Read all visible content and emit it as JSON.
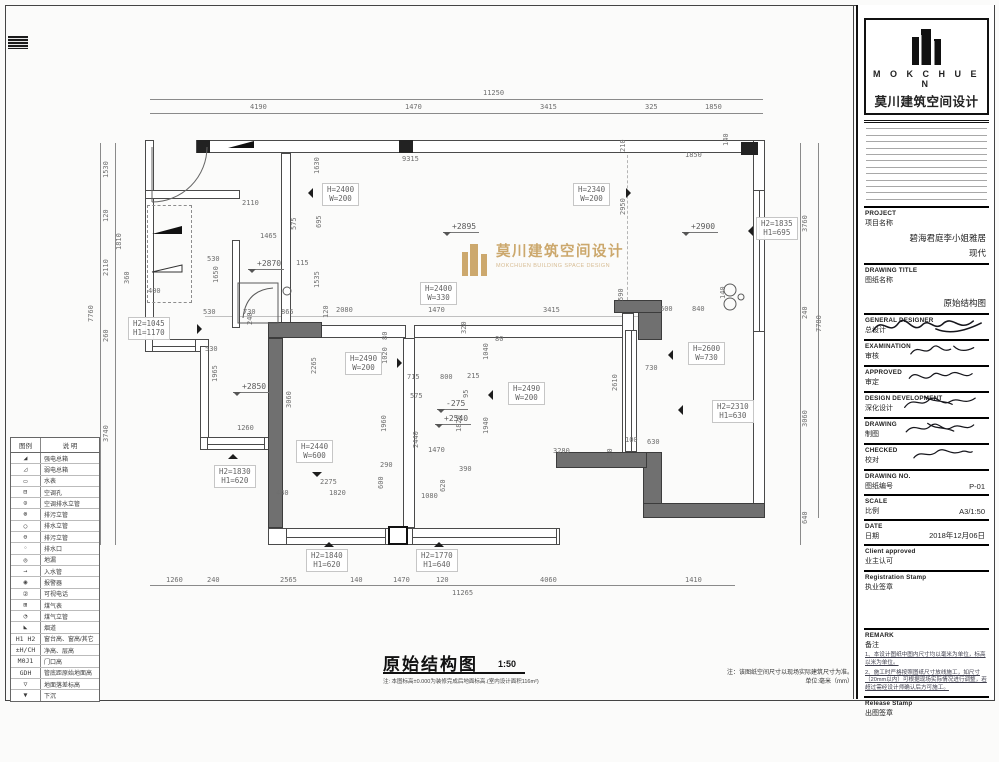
{
  "watermark": {
    "cn": "莫川建筑空间设计",
    "en": "MOKCHUEN BUILDING SPACE DESIGN",
    "gold": "#c7a05e"
  },
  "footer": {
    "title": "原始结构图",
    "scale": "1:50",
    "note": "注: 本图标高±0.000为装修完成后地面标高.(室内设计面积116m²)",
    "right_note1": "注：该图纸空间尺寸以现场实际建筑尺寸为准。",
    "right_note2": "单位:毫米（mm）"
  },
  "legend": {
    "col1": "图例",
    "col2": "说 明",
    "rows": [
      {
        "sym": "◢",
        "label": "强电总箱"
      },
      {
        "sym": "◿",
        "label": "弱电总箱"
      },
      {
        "sym": "▭",
        "label": "水表"
      },
      {
        "sym": "⊟",
        "label": "空调孔"
      },
      {
        "sym": "⊙",
        "label": "空调排水立管"
      },
      {
        "sym": "⊗",
        "label": "排污立管"
      },
      {
        "sym": "○",
        "label": "排水立管"
      },
      {
        "sym": "⊖",
        "label": "排污立管"
      },
      {
        "sym": "◦",
        "label": "排水口"
      },
      {
        "sym": "◎",
        "label": "地漏"
      },
      {
        "sym": "→",
        "label": "入水管"
      },
      {
        "sym": "◉",
        "label": "报警器"
      },
      {
        "sym": "②",
        "label": "可视电话"
      },
      {
        "sym": "⊞",
        "label": "煤气表"
      },
      {
        "sym": "◔",
        "label": "煤气立管"
      },
      {
        "sym": "◣",
        "label": "烟道"
      },
      {
        "sym": "H1 H2",
        "label": "窗台高、窗高/其它"
      },
      {
        "sym": "±H/CH",
        "label": "净高、层高"
      },
      {
        "sym": "M0J1",
        "label": "门口高"
      },
      {
        "sym": "GDH",
        "label": "管底距原始地面高"
      },
      {
        "sym": "▽",
        "label": "地面落差标高"
      },
      {
        "sym": "▼",
        "label": "下沉"
      }
    ]
  },
  "titleblock": {
    "brand_en": "M O K C H U E N",
    "brand_cn": "莫川建筑空间设计",
    "fields": [
      {
        "en": "PROJECT",
        "cn": "项目名称",
        "kind": "value",
        "value": "碧海君庭李小姐雅居",
        "value2": "现代"
      },
      {
        "en": "DRAWING TITLE",
        "cn": "图纸名称",
        "kind": "value",
        "value": "原始结构图",
        "gap": true
      },
      {
        "en": "GENERAL DESIGNER",
        "cn": "总设计",
        "kind": "sign"
      },
      {
        "en": "EXAMINATION",
        "cn": "审核",
        "kind": "sign"
      },
      {
        "en": "APPROVED",
        "cn": "审定",
        "kind": "sign"
      },
      {
        "en": "DESIGN DEVELOPMENT",
        "cn": "深化设计",
        "kind": "sign"
      },
      {
        "en": "DRAWING",
        "cn": "制图",
        "kind": "sign"
      },
      {
        "en": "CHECKED",
        "cn": "校对",
        "kind": "sign"
      },
      {
        "en": "DRAWING NO.",
        "cn": "图纸编号",
        "kind": "value",
        "value": "P-01",
        "inline": true
      },
      {
        "en": "SCALE",
        "cn": "比例",
        "kind": "value",
        "value": "A3/1:50",
        "inline": true
      },
      {
        "en": "DATE",
        "cn": "日期",
        "kind": "value",
        "value": "2018年12月06日",
        "inline": true
      },
      {
        "en": "Client approved",
        "cn": "业主认可",
        "kind": "label"
      },
      {
        "en": "Registration Stamp",
        "cn": "执业签章",
        "kind": "stamp"
      },
      {
        "en": "REMARK",
        "cn": "备注",
        "kind": "remark",
        "notes": [
          "1、本设计图纸中图内尺寸均以毫米为单位，标高以米为单位。",
          "2、施工时严格按照图纸尺寸放线施工，如尺寸（20mm以内）可根据现场实际情况进行调整，若超过需经设计师确认后方可施工。"
        ]
      },
      {
        "en": "Release Stamp",
        "cn": "出图签章",
        "kind": "release"
      }
    ]
  },
  "plan": {
    "dims": [
      {
        "x": 483,
        "y": 90,
        "t": "11250"
      },
      {
        "x": 250,
        "y": 104,
        "t": "4190"
      },
      {
        "x": 405,
        "y": 104,
        "t": "1470"
      },
      {
        "x": 540,
        "y": 104,
        "t": "3415"
      },
      {
        "x": 645,
        "y": 104,
        "t": "325"
      },
      {
        "x": 705,
        "y": 104,
        "t": "1850"
      },
      {
        "x": 402,
        "y": 156,
        "t": "9315"
      },
      {
        "x": 685,
        "y": 152,
        "t": "1850"
      },
      {
        "x": 620,
        "y": 152,
        "t": "210",
        "r": 1
      },
      {
        "x": 723,
        "y": 146,
        "t": "140",
        "r": 1
      },
      {
        "x": 88,
        "y": 322,
        "t": "7760",
        "r": 1
      },
      {
        "x": 103,
        "y": 178,
        "t": "1530",
        "r": 1
      },
      {
        "x": 103,
        "y": 222,
        "t": "120",
        "r": 1
      },
      {
        "x": 103,
        "y": 276,
        "t": "2110",
        "r": 1
      },
      {
        "x": 103,
        "y": 342,
        "t": "260",
        "r": 1
      },
      {
        "x": 103,
        "y": 442,
        "t": "3740",
        "r": 1
      },
      {
        "x": 116,
        "y": 250,
        "t": "1810",
        "r": 1
      },
      {
        "x": 124,
        "y": 284,
        "t": "360",
        "r": 1
      },
      {
        "x": 148,
        "y": 288,
        "t": "400"
      },
      {
        "x": 816,
        "y": 332,
        "t": "7780",
        "r": 1
      },
      {
        "x": 802,
        "y": 232,
        "t": "3760",
        "r": 1
      },
      {
        "x": 802,
        "y": 319,
        "t": "240",
        "r": 1
      },
      {
        "x": 802,
        "y": 427,
        "t": "3060",
        "r": 1
      },
      {
        "x": 802,
        "y": 524,
        "t": "640",
        "r": 1
      },
      {
        "x": 166,
        "y": 577,
        "t": "1260"
      },
      {
        "x": 207,
        "y": 577,
        "t": "240"
      },
      {
        "x": 280,
        "y": 577,
        "t": "2565"
      },
      {
        "x": 350,
        "y": 577,
        "t": "140"
      },
      {
        "x": 393,
        "y": 577,
        "t": "1470"
      },
      {
        "x": 436,
        "y": 577,
        "t": "120"
      },
      {
        "x": 540,
        "y": 577,
        "t": "4060"
      },
      {
        "x": 685,
        "y": 577,
        "t": "1410"
      },
      {
        "x": 452,
        "y": 590,
        "t": "11265"
      },
      {
        "x": 242,
        "y": 200,
        "t": "2110"
      },
      {
        "x": 260,
        "y": 233,
        "t": "1465"
      },
      {
        "x": 291,
        "y": 230,
        "t": "575",
        "r": 1
      },
      {
        "x": 207,
        "y": 256,
        "t": "530"
      },
      {
        "x": 213,
        "y": 283,
        "t": "1650",
        "r": 1
      },
      {
        "x": 314,
        "y": 174,
        "t": "1630",
        "r": 1
      },
      {
        "x": 316,
        "y": 228,
        "t": "695",
        "r": 1
      },
      {
        "x": 296,
        "y": 260,
        "t": "115"
      },
      {
        "x": 314,
        "y": 288,
        "t": "1535",
        "r": 1
      },
      {
        "x": 237,
        "y": 425,
        "t": "1260"
      },
      {
        "x": 203,
        "y": 309,
        "t": "530"
      },
      {
        "x": 243,
        "y": 309,
        "t": "730"
      },
      {
        "x": 281,
        "y": 309,
        "t": "865"
      },
      {
        "x": 336,
        "y": 307,
        "t": "2080"
      },
      {
        "x": 428,
        "y": 307,
        "t": "1470"
      },
      {
        "x": 543,
        "y": 307,
        "t": "3415"
      },
      {
        "x": 205,
        "y": 346,
        "t": "530"
      },
      {
        "x": 247,
        "y": 325,
        "t": "240",
        "r": 1
      },
      {
        "x": 323,
        "y": 318,
        "t": "120",
        "r": 1
      },
      {
        "x": 212,
        "y": 382,
        "t": "1965",
        "r": 1
      },
      {
        "x": 311,
        "y": 374,
        "t": "2265",
        "r": 1
      },
      {
        "x": 382,
        "y": 340,
        "t": "80",
        "r": 1
      },
      {
        "x": 382,
        "y": 364,
        "t": "1020",
        "r": 1
      },
      {
        "x": 461,
        "y": 334,
        "t": "320",
        "r": 1
      },
      {
        "x": 495,
        "y": 336,
        "t": "80"
      },
      {
        "x": 483,
        "y": 360,
        "t": "1040",
        "r": 1
      },
      {
        "x": 407,
        "y": 374,
        "t": "715"
      },
      {
        "x": 440,
        "y": 374,
        "t": "800"
      },
      {
        "x": 467,
        "y": 373,
        "t": "215"
      },
      {
        "x": 410,
        "y": 393,
        "t": "575"
      },
      {
        "x": 463,
        "y": 398,
        "t": "95",
        "r": 1
      },
      {
        "x": 286,
        "y": 408,
        "t": "3060",
        "r": 1
      },
      {
        "x": 381,
        "y": 432,
        "t": "1960",
        "r": 1
      },
      {
        "x": 413,
        "y": 448,
        "t": "2440",
        "r": 1
      },
      {
        "x": 456,
        "y": 432,
        "t": "1820",
        "r": 1
      },
      {
        "x": 483,
        "y": 434,
        "t": "1940",
        "r": 1
      },
      {
        "x": 428,
        "y": 447,
        "t": "1470"
      },
      {
        "x": 380,
        "y": 462,
        "t": "290"
      },
      {
        "x": 459,
        "y": 466,
        "t": "390"
      },
      {
        "x": 440,
        "y": 492,
        "t": "620",
        "r": 1
      },
      {
        "x": 378,
        "y": 489,
        "t": "600",
        "r": 1
      },
      {
        "x": 320,
        "y": 479,
        "t": "2275"
      },
      {
        "x": 276,
        "y": 490,
        "t": "440"
      },
      {
        "x": 329,
        "y": 490,
        "t": "1820"
      },
      {
        "x": 421,
        "y": 493,
        "t": "1080"
      },
      {
        "x": 620,
        "y": 215,
        "t": "2950",
        "r": 1
      },
      {
        "x": 618,
        "y": 301,
        "t": "590",
        "r": 1
      },
      {
        "x": 660,
        "y": 306,
        "t": "600"
      },
      {
        "x": 692,
        "y": 306,
        "t": "840"
      },
      {
        "x": 720,
        "y": 299,
        "t": "140",
        "r": 1
      },
      {
        "x": 645,
        "y": 365,
        "t": "730"
      },
      {
        "x": 612,
        "y": 391,
        "t": "2610",
        "r": 1
      },
      {
        "x": 625,
        "y": 437,
        "t": "100"
      },
      {
        "x": 647,
        "y": 439,
        "t": "630"
      },
      {
        "x": 607,
        "y": 461,
        "t": "330",
        "r": 1
      },
      {
        "x": 553,
        "y": 448,
        "t": "3280"
      }
    ],
    "boxes": [
      {
        "x": 322,
        "y": 183,
        "a": "H=2400",
        "b": "W=200",
        "ar": "left",
        "ax": 303,
        "ay": 188
      },
      {
        "x": 573,
        "y": 183,
        "a": "H=2340",
        "b": "W=200",
        "ar": "right",
        "ax": 626,
        "ay": 188
      },
      {
        "x": 420,
        "y": 282,
        "a": "H=2400",
        "b": "W=330"
      },
      {
        "x": 345,
        "y": 352,
        "a": "H=2490",
        "b": "W=200",
        "ar": "right",
        "ax": 397,
        "ay": 358
      },
      {
        "x": 508,
        "y": 382,
        "a": "H=2490",
        "b": "W=200",
        "ar": "left",
        "ax": 483,
        "ay": 390
      },
      {
        "x": 296,
        "y": 440,
        "a": "H=2440",
        "b": "W=600",
        "ar": "down",
        "ax": 312,
        "ay": 472
      },
      {
        "x": 128,
        "y": 317,
        "a": "H2=1045",
        "b": "H1=1170",
        "ar": "right",
        "ax": 197,
        "ay": 324
      },
      {
        "x": 756,
        "y": 217,
        "a": "H2=1835",
        "b": "H1=695",
        "ar": "left",
        "ax": 743,
        "ay": 226
      },
      {
        "x": 688,
        "y": 342,
        "a": "H=2600",
        "b": "W=730",
        "ar": "left",
        "ax": 663,
        "ay": 350
      },
      {
        "x": 712,
        "y": 400,
        "a": "H2=2310",
        "b": "H1=630",
        "ar": "left",
        "ax": 673,
        "ay": 405
      },
      {
        "x": 214,
        "y": 465,
        "a": "H2=1830",
        "b": "H1=620",
        "ar": "up",
        "ax": 228,
        "ay": 449
      },
      {
        "x": 306,
        "y": 549,
        "a": "H2=1840",
        "b": "H1=620",
        "ar": "up",
        "ax": 324,
        "ay": 537
      },
      {
        "x": 416,
        "y": 549,
        "a": "H2=1770",
        "b": "H1=640",
        "ar": "up",
        "ax": 434,
        "ay": 537
      }
    ],
    "levels": [
      {
        "x": 443,
        "y": 222,
        "t": "+2895"
      },
      {
        "x": 682,
        "y": 222,
        "t": "+2900"
      },
      {
        "x": 248,
        "y": 259,
        "t": "+2870"
      },
      {
        "x": 233,
        "y": 382,
        "t": "+2850"
      },
      {
        "x": 435,
        "y": 414,
        "t": "+2540"
      },
      {
        "x": 437,
        "y": 399,
        "t": "-275"
      }
    ]
  }
}
